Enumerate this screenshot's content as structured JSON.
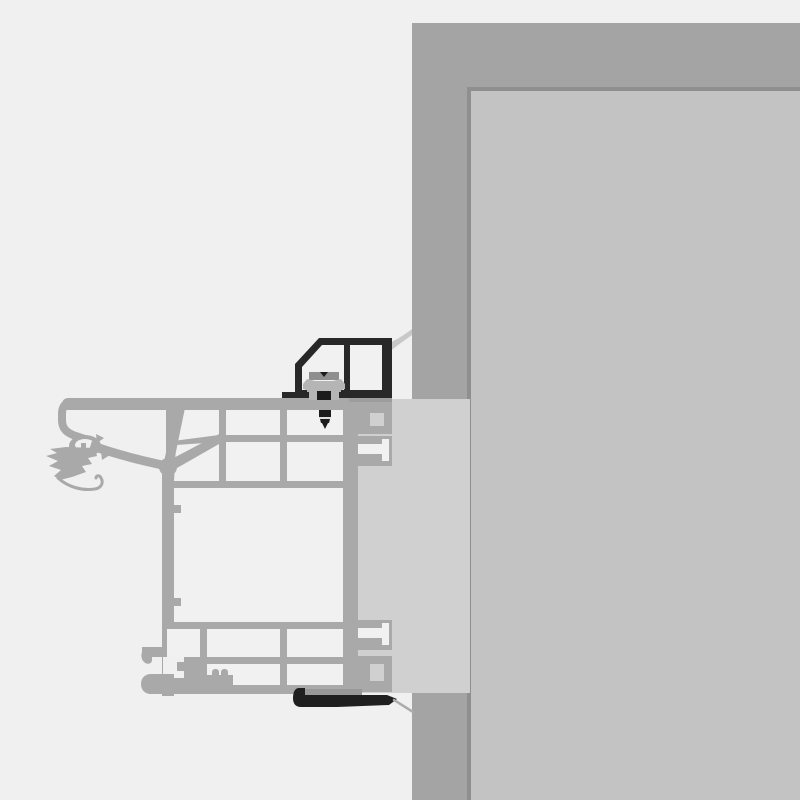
{
  "figure": {
    "type": "technical-cross-section-diagram",
    "subject": "window-frame-to-masonry-wall-installation-detail",
    "text_content": [],
    "parts": [
      "masonry-wall-section",
      "interior-wall-face",
      "reveal-filler-panel",
      "window-frame-profile",
      "frame-glazing-gasket",
      "frame-hardware-groove",
      "frame-connector-clips",
      "cover-profile",
      "fastening-clip",
      "fastening-screw",
      "top-sealing-membrane",
      "bottom-sealing-tape"
    ]
  },
  "palette": {
    "background": "#f0f0f0",
    "wall_section": "#a4a4a4",
    "wall_face": "#c3c3c3",
    "wall_edge_line": "#8f8f8f",
    "filler_panel": "#d0d0d0",
    "frame_gray": "#a9a9a9",
    "frame_cavity": "#f1f1f1",
    "cover_profile_black": "#282828",
    "clip_gray": "#b5b5b5",
    "clip_plate_gray": "#8f8f8f",
    "membrane_gray": "#c8c8c8",
    "pad_gray": "#9d9d9d",
    "seal_backing_gray": "#989898",
    "seal_black": "#1f1f1f",
    "screw_black": "#1c1c1c",
    "screw_highlight": "#e0e0e0",
    "tail_gray": "#ababab"
  }
}
